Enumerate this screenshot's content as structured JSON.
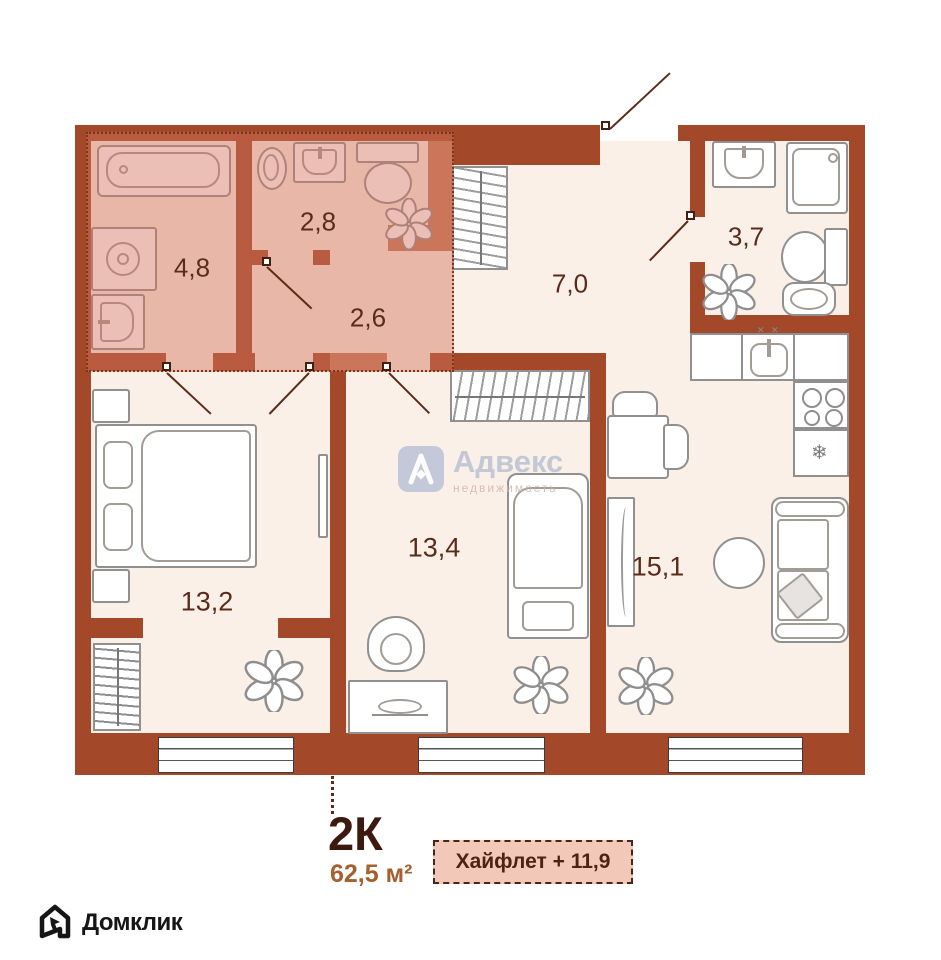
{
  "plan": {
    "unit_type": "2К",
    "total_area": "62,5 м²",
    "highlight_badge": "Хайфлет + 11,9",
    "rooms": [
      {
        "name": "bathroom-master",
        "area": "4,8"
      },
      {
        "name": "bathroom-2",
        "area": "2,8"
      },
      {
        "name": "hall-inner",
        "area": "2,6"
      },
      {
        "name": "hallway",
        "area": "7,0"
      },
      {
        "name": "bathroom-3",
        "area": "3,7"
      },
      {
        "name": "bedroom",
        "area": "13,2"
      },
      {
        "name": "room-2",
        "area": "13,4"
      },
      {
        "name": "kitchen-living",
        "area": "15,1"
      }
    ],
    "kitchen_sink_marks": "✕ ✕"
  },
  "icons": {
    "snowflake": "❄"
  },
  "watermark": {
    "title": "Адвекс",
    "subtitle": "недвижимость"
  },
  "footer_logo": {
    "text": "Домклик"
  },
  "colors": {
    "wall": "#A3492A",
    "wall_highlighted": "#C57A5B",
    "floor": "#FBF0E7",
    "highlight_fill": "#E9B7A8",
    "room_label": "#5A2B1B",
    "area_text": "#A4602F",
    "badge_bg": "#F2C9B8",
    "badge_border": "#4D2316",
    "watermark_blue": "#B4BFD3"
  }
}
